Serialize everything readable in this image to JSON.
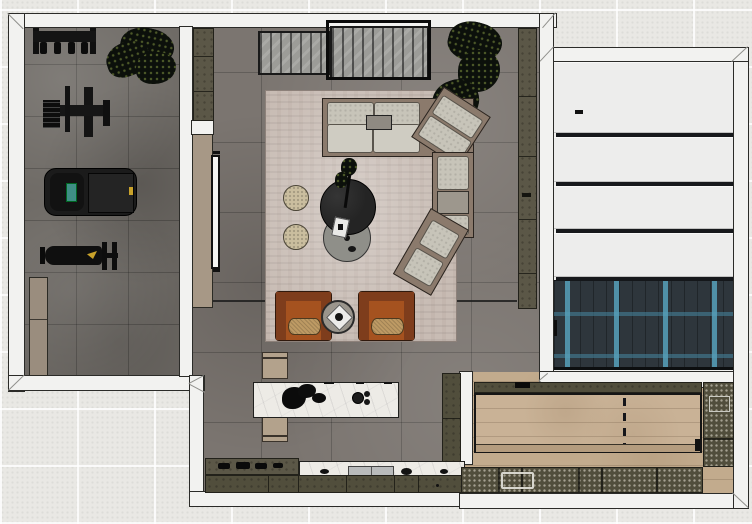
{
  "meta": {
    "scene": "top-down-3d-floorplan-render"
  },
  "palette": {
    "exterior": "#e9e8e4",
    "wall": "#f2f2f0",
    "gym_floor": "#6e6a65",
    "living_floor": "#7b7570",
    "rug": "#c8bcb4",
    "sofa_base": "#8b7a6c",
    "sofa_cushion": "#c7c4b9",
    "coffee_table_dark": "#242424",
    "coffee_table_gray": "#8f8f89",
    "pouf": "#cabe9f",
    "armchair": "#a5521f",
    "armchair_dark": "#7e3d1c",
    "armchair_seat": "#bd9a64",
    "side_table": "#9a958c",
    "olive_cabinet": "#5b5747",
    "kitchen_cabinet": "#514e3c",
    "tan_cabinet": "#9a8d7e",
    "media_panel": "#a79886",
    "tv_screen": "#f5f5f3",
    "marble": "#edebe6",
    "bench": "#b3a28c",
    "wardrobe_panel": "#ededec",
    "herringbone_base": "#2e363c",
    "wood_floor": "#c2ab8d",
    "game_table_top": "#c9b296",
    "plant": "#0c100b",
    "equipment_black": "#141414",
    "treadmill": "#1b1b1b",
    "accent_yellow": "#c9a22a",
    "console_screen": "#3f8e85",
    "slat_sideboard": "#9c9c98",
    "frame_black": "#0b0b0b",
    "zone_line": "#1d1d1d"
  },
  "rooms": {
    "gym": {
      "items": [
        "weight-rack",
        "floor-plant",
        "cable-machine",
        "treadmill",
        "workout-bench",
        "storage-cabinet"
      ]
    },
    "living_room": {
      "items": [
        "slatted-sideboard",
        "window-frame",
        "tall-plant",
        "area-rug",
        "sectional-sofa",
        "chaise-lounge",
        "coffee-tables",
        "floor-poufs",
        "leather-armchairs",
        "round-side-table",
        "tv-media-panel",
        "wall-shelf-cabinets"
      ]
    },
    "kitchen": {
      "items": [
        "marble-island",
        "island-benches",
        "cooktop-counter",
        "sink-counter",
        "base-cabinets",
        "tall-cabinet"
      ]
    },
    "wardrobe_hall": {
      "items": [
        "wardrobe-panels",
        "herringbone-floor"
      ]
    },
    "game_room": {
      "items": [
        "game-table",
        "sideboard-cabinets",
        "side-cabinets",
        "wood-floor"
      ]
    }
  }
}
